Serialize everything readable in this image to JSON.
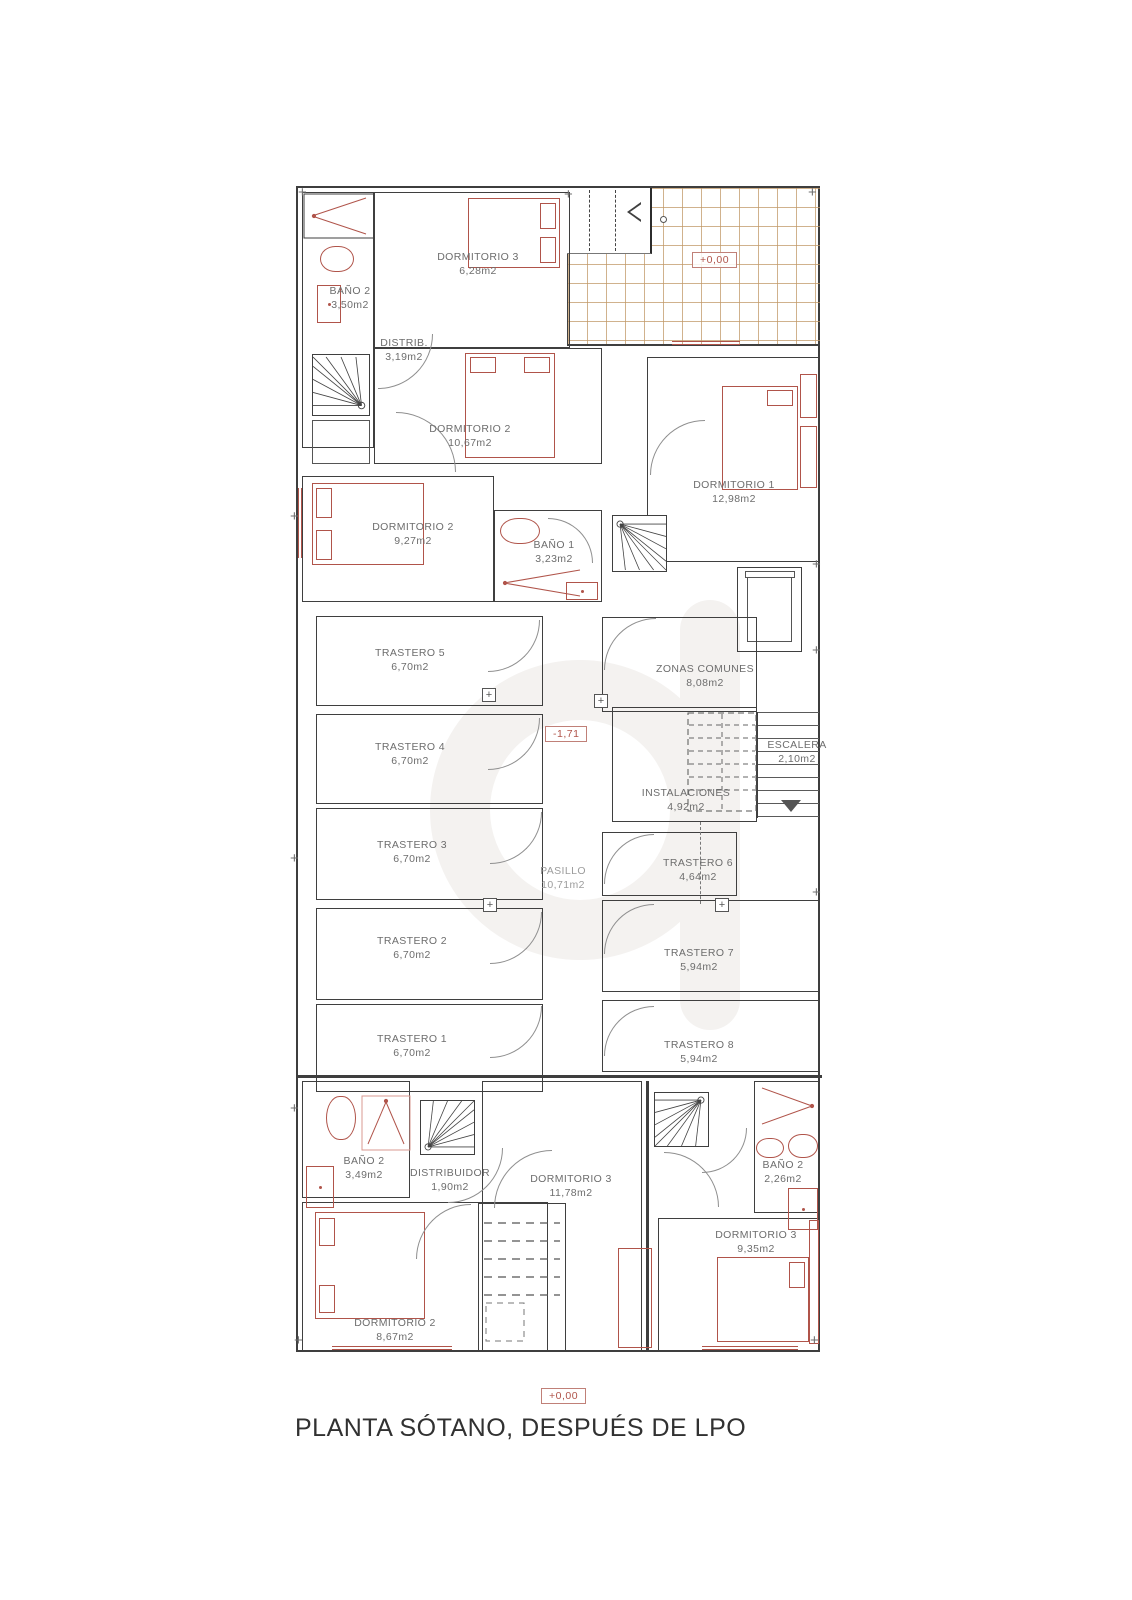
{
  "title": "PLANTA SÓTANO, DESPUÉS DE LPO",
  "markers": {
    "terrace_level": "+0,00",
    "corridor_level": "-1,71",
    "street_level": "+0,00"
  },
  "rooms": {
    "bano2_top": {
      "name": "BAÑO 2",
      "area": "3,50m2"
    },
    "dorm3_top": {
      "name": "DORMITORIO 3",
      "area": "6,28m2"
    },
    "distrib": {
      "name": "DISTRIB.",
      "area": "3,19m2"
    },
    "dorm2_top": {
      "name": "DORMITORIO 2",
      "area": "10,67m2"
    },
    "dorm2_mid": {
      "name": "DORMITORIO 2",
      "area": "9,27m2"
    },
    "bano1": {
      "name": "BAÑO 1",
      "area": "3,23m2"
    },
    "dorm1": {
      "name": "DORMITORIO 1",
      "area": "12,98m2"
    },
    "t5": {
      "name": "TRASTERO 5",
      "area": "6,70m2"
    },
    "t4": {
      "name": "TRASTERO 4",
      "area": "6,70m2"
    },
    "t3": {
      "name": "TRASTERO 3",
      "area": "6,70m2"
    },
    "t2": {
      "name": "TRASTERO 2",
      "area": "6,70m2"
    },
    "t1": {
      "name": "TRASTERO 1",
      "area": "6,70m2"
    },
    "zonas": {
      "name": "ZONAS COMUNES",
      "area": "8,08m2"
    },
    "escalera": {
      "name": "ESCALERA",
      "area": "2,10m2"
    },
    "instal": {
      "name": "INSTALACIONES",
      "area": "4,92m2"
    },
    "t6": {
      "name": "TRASTERO 6",
      "area": "4,64m2"
    },
    "t7": {
      "name": "TRASTERO 7",
      "area": "5,94m2"
    },
    "t8": {
      "name": "TRASTERO 8",
      "area": "5,94m2"
    },
    "pasillo": {
      "name": "PASILLO",
      "area": "10,71m2"
    },
    "bano2_bl": {
      "name": "BAÑO 2",
      "area": "3,49m2"
    },
    "distribuidor": {
      "name": "DISTRIBUIDOR",
      "area": "1,90m2"
    },
    "dorm3_bc": {
      "name": "DORMITORIO 3",
      "area": "11,78m2"
    },
    "bano2_br": {
      "name": "BAÑO 2",
      "area": "2,26m2"
    },
    "dorm3_br": {
      "name": "DORMITORIO 3",
      "area": "9,35m2"
    },
    "dorm2_b": {
      "name": "DORMITORIO 2",
      "area": "8,67m2"
    }
  },
  "colors": {
    "wall": "#3e3e3e",
    "furniture_accent": "#b0544a",
    "tile_grid": "#c19867",
    "label_text": "#6d6d6d",
    "marker_text": "#b0544a"
  }
}
